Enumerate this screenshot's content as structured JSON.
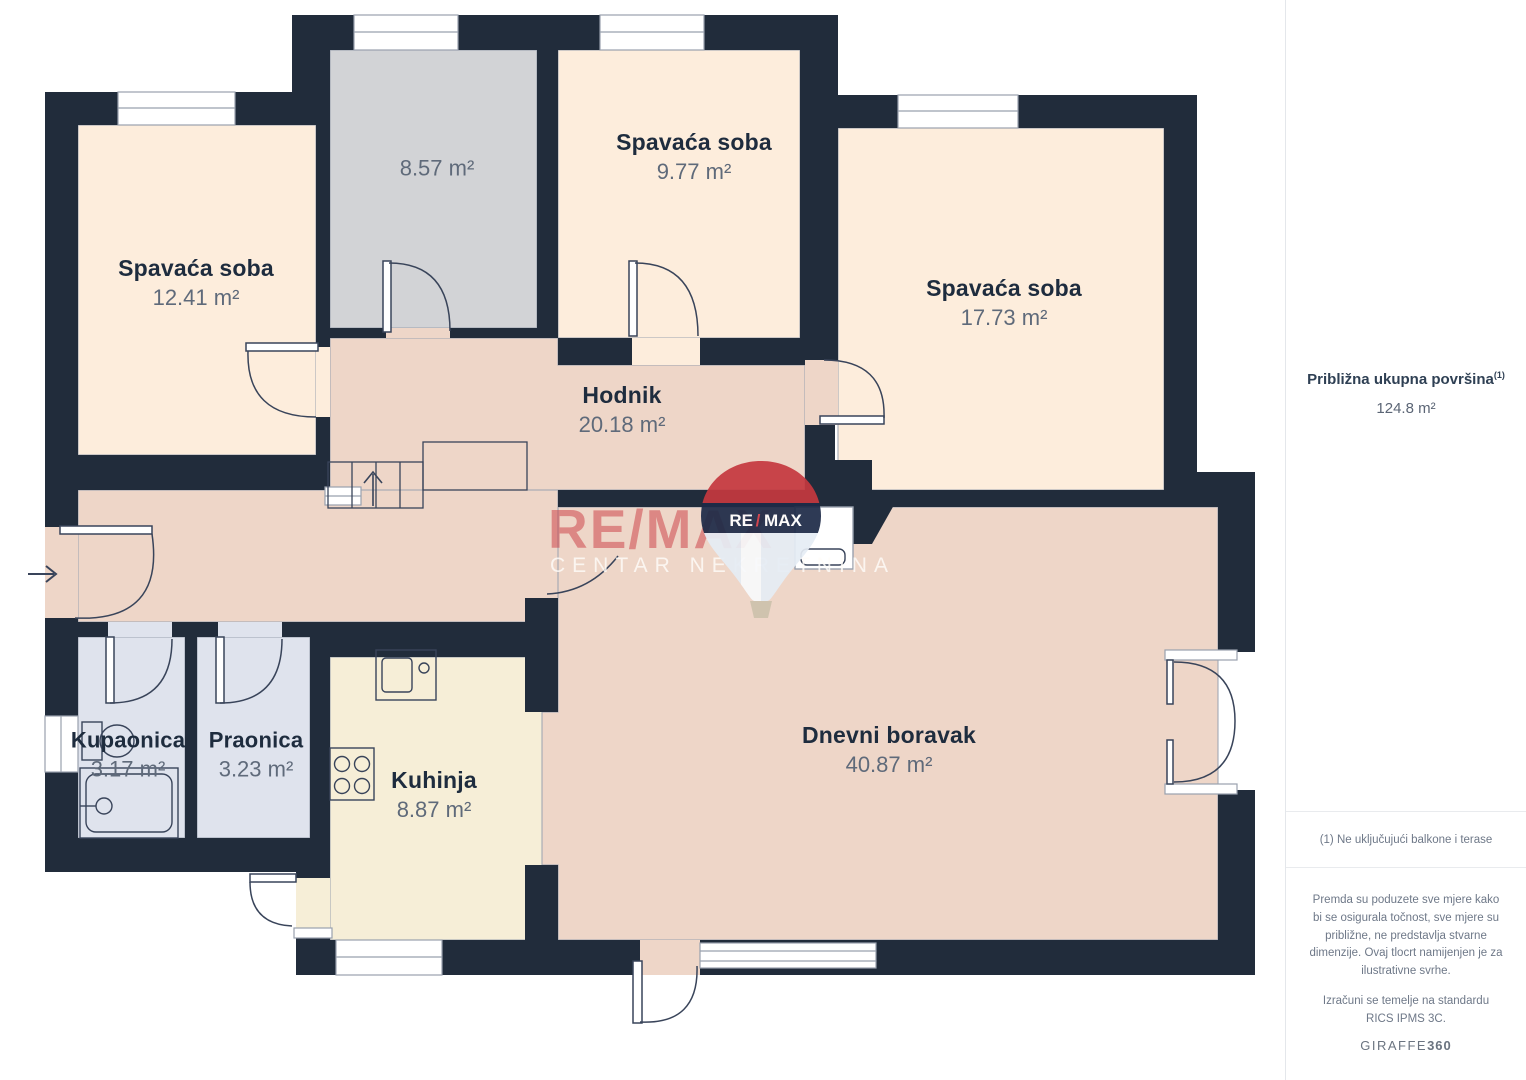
{
  "plan": {
    "rooms": [
      {
        "id": "bedroom-1",
        "name": "Spavaća soba",
        "area": "12.41 m²"
      },
      {
        "id": "storage",
        "name": "",
        "area": "8.57 m²"
      },
      {
        "id": "bedroom-2",
        "name": "Spavaća soba",
        "area": "9.77 m²"
      },
      {
        "id": "bedroom-3",
        "name": "Spavaća soba",
        "area": "17.73 m²"
      },
      {
        "id": "hallway",
        "name": "Hodnik",
        "area": "20.18 m²"
      },
      {
        "id": "bathroom",
        "name": "Kupaonica",
        "area": "3.17 m²"
      },
      {
        "id": "laundry",
        "name": "Praonica",
        "area": "3.23 m²"
      },
      {
        "id": "kitchen",
        "name": "Kuhinja",
        "area": "8.87 m²"
      },
      {
        "id": "living-room",
        "name": "Dnevni boravak",
        "area": "40.87 m²"
      }
    ],
    "watermark": {
      "brand": "RE/MAX",
      "subtitle": "CENTAR NEKRETNINA",
      "balloon_re": "RE",
      "balloon_slash": "/",
      "balloon_max": "MAX"
    },
    "colors": {
      "wall": "#212c3b",
      "bedroom": "#fdeddc",
      "storage": "#d2d3d6",
      "hall_living": "#eed6c8",
      "kitchen": "#f6eed7",
      "bath": "#dfe3ed",
      "watermark_red": "#cb3a42"
    }
  },
  "sidebar": {
    "total_label": "Približna ukupna površina",
    "total_sup": "(1)",
    "total_value": "124.8 m²",
    "footnote": "(1) Ne uključujući balkone i terase",
    "disclaimer": "Premda su poduzete sve mjere kako bi se osigurala točnost, sve mjere su približne, ne predstavlja stvarne dimenzije. Ovaj tlocrt namijenjen je za ilustrativne svrhe.",
    "standard": "Izračuni se temelje na standardu RICS IPMS 3C.",
    "brand": "GIRAFFE",
    "brand_bold": "360"
  }
}
